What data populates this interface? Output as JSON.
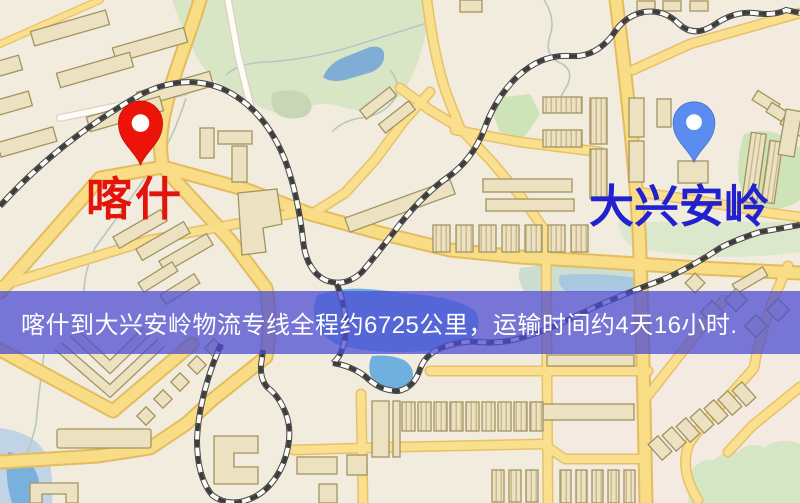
{
  "page": {
    "type": "logistics-route-map",
    "width_px": 800,
    "height_px": 503
  },
  "markers": {
    "origin": {
      "label": "喀什",
      "pin_color": "#ec1408",
      "label_color": "#e2140c"
    },
    "destination": {
      "label": "大兴安岭",
      "pin_color": "#5b8cf0",
      "label_color": "#2121cd"
    }
  },
  "banner": {
    "text": "喀什到大兴安岭物流专线全程约6725公里，运输时间约4天16小时.",
    "bg_color": "rgba(76,76,210,0.74)",
    "text_color": "#ffffff"
  },
  "route": {
    "origin": "喀什",
    "destination": "大兴安岭",
    "distance_km": 6725,
    "duration": "4天16小时"
  }
}
